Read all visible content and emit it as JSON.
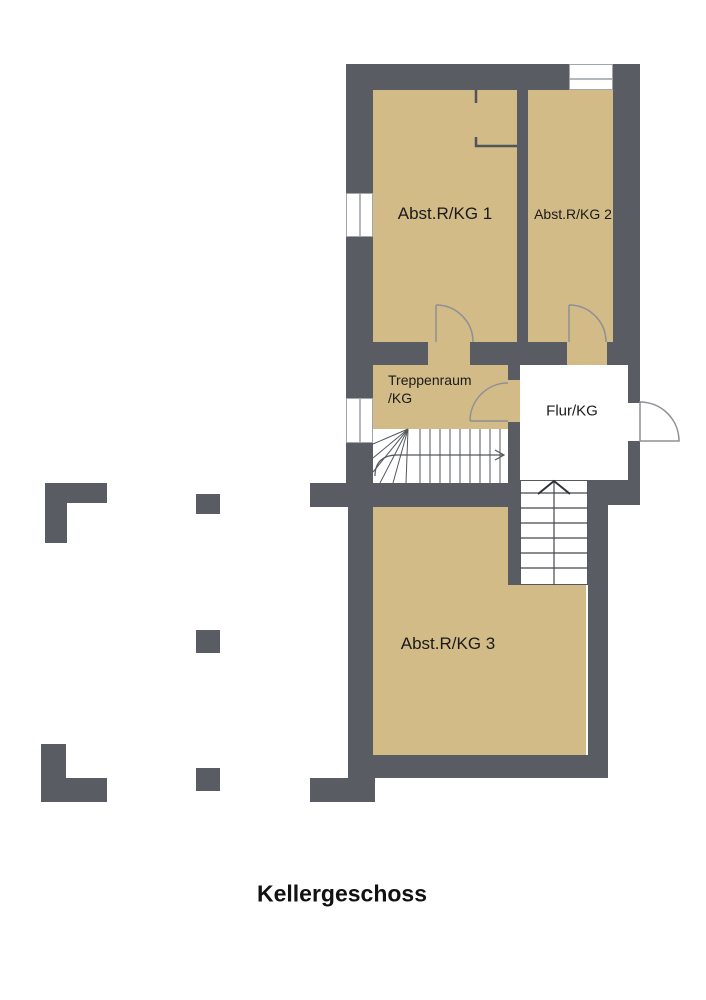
{
  "title": {
    "text": "Kellergeschoss"
  },
  "plan": {
    "floor_name": "Kellergeschoss",
    "rooms": [
      {
        "label": "Abst.R/KG 1",
        "floor": "tan"
      },
      {
        "label": "Abst.R/KG 2",
        "floor": "tan"
      },
      {
        "label": "Treppenraum\n/KG",
        "floor": "tan"
      },
      {
        "label": "Flur/KG",
        "floor": "white"
      },
      {
        "label": "Abst.R/KG 3",
        "floor": "tan"
      }
    ],
    "stairs": [
      {
        "name": "winder-staircase",
        "symbol": "walk-line-arrow-icon"
      },
      {
        "name": "straight-staircase",
        "symbol": "up-arrow-icon"
      }
    ],
    "doors": 4,
    "windows": 3,
    "colors": {
      "wall": "#595d63",
      "room_floor": "#d2bb87",
      "corridor_floor": "#ffffff",
      "background": "#ffffff",
      "door_line": "#8d9096",
      "stair_line": "#53575d",
      "thin_partition": "#4f545a",
      "label_text": "#1a1a1a"
    }
  }
}
